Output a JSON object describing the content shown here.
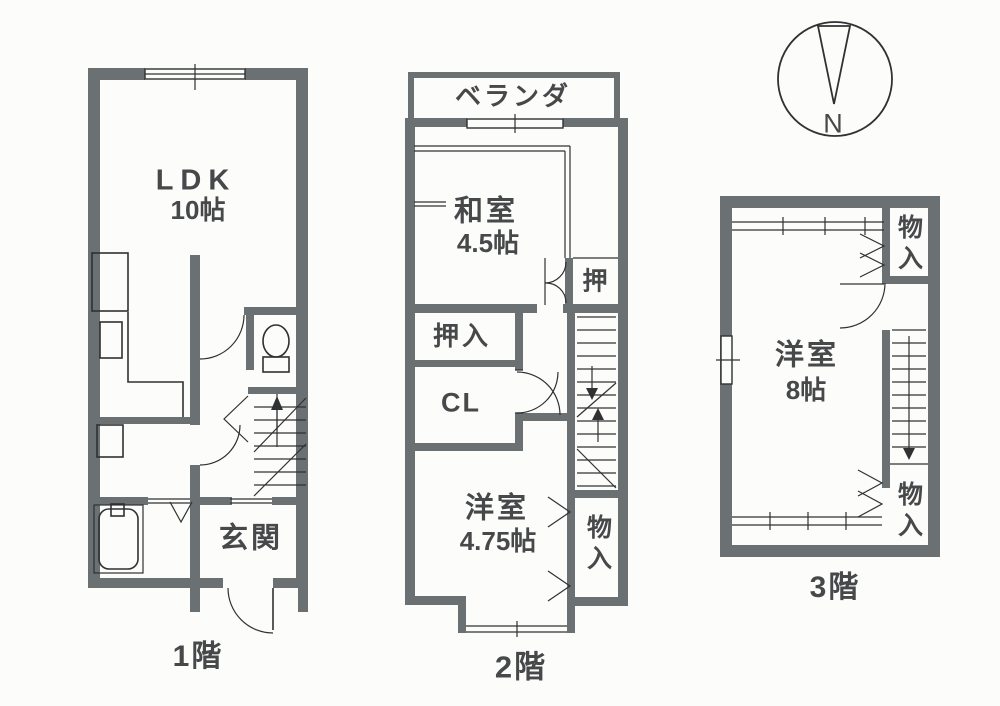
{
  "document_type": "floor-plan-scan",
  "colors": {
    "wall": "#6b7073",
    "line": "#2f3133",
    "text": "#46484a",
    "bg": "#fcfcfa"
  },
  "compass": {
    "north_label": "N"
  },
  "floor1": {
    "floor_label": "1階",
    "ldk_label": "LDK",
    "ldk_size": "10帖",
    "genkan_label": "玄関"
  },
  "floor2": {
    "floor_label": "2階",
    "veranda_label": "ベランダ",
    "washitsu_label": "和室",
    "washitsu_size": "4.5帖",
    "oshi_label": "押",
    "oshiire_label": "押入",
    "closet_label": "CL",
    "yoshitsu_label": "洋室",
    "yoshitsu_size": "4.75帖",
    "monoire_label": "物入"
  },
  "floor3": {
    "floor_label": "3階",
    "yoshitsu_label": "洋室",
    "yoshitsu_size": "8帖",
    "monoire_top_label": "物入",
    "monoire_bottom_label": "物入"
  }
}
